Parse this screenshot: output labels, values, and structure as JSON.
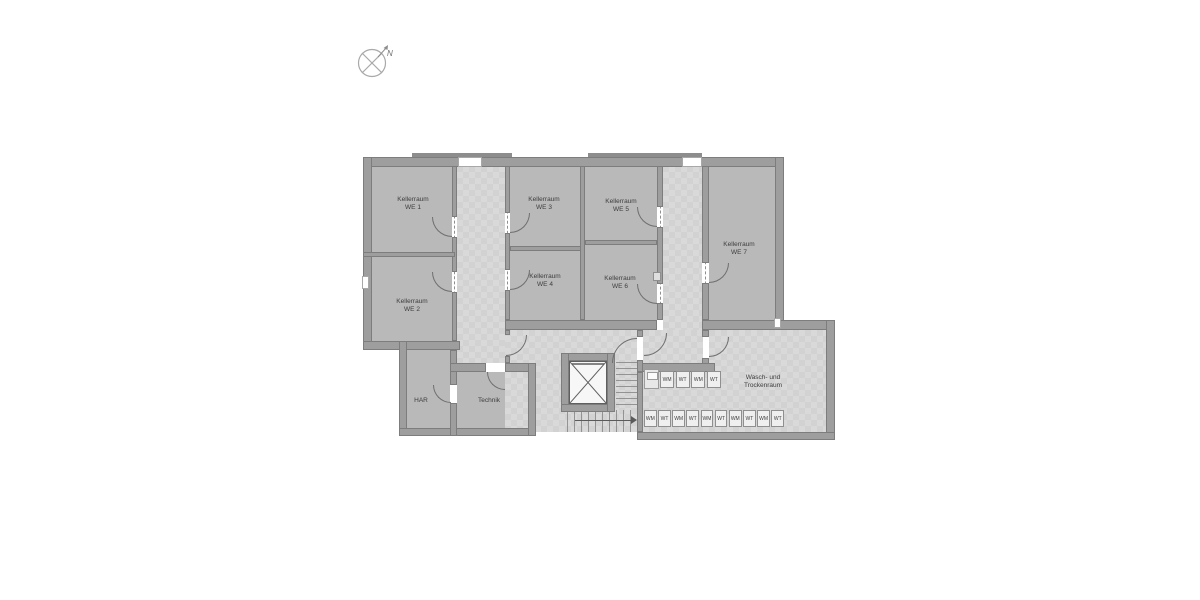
{
  "compass": {
    "north_label": "N"
  },
  "rooms": {
    "we1": {
      "name": "Kellerraum",
      "unit": "WE 1"
    },
    "we2": {
      "name": "Kellerraum",
      "unit": "WE 2"
    },
    "we3": {
      "name": "Kellerraum",
      "unit": "WE 3"
    },
    "we4": {
      "name": "Kellerraum",
      "unit": "WE 4"
    },
    "we5": {
      "name": "Kellerraum",
      "unit": "WE 5"
    },
    "we6": {
      "name": "Kellerraum",
      "unit": "WE 6"
    },
    "we7": {
      "name": "Kellerraum",
      "unit": "WE 7"
    },
    "har": {
      "name": "HAR"
    },
    "technik": {
      "name": "Technik"
    },
    "laundry": {
      "line1": "Wasch- und",
      "line2": "Trockenraum"
    }
  },
  "laundry_appliances": {
    "top_row": [
      "WM",
      "WT",
      "WM",
      "WT"
    ],
    "bottom_row": [
      "WM",
      "WT",
      "WM",
      "WT",
      "WM",
      "WT",
      "WM",
      "WT",
      "WM",
      "WT"
    ]
  },
  "colors": {
    "background": "#ffffff",
    "wall": "#9e9e9e",
    "room_fill": "#b9b9b9",
    "circulation_fill": "#d2d2d2",
    "text": "#3d3d3d"
  }
}
